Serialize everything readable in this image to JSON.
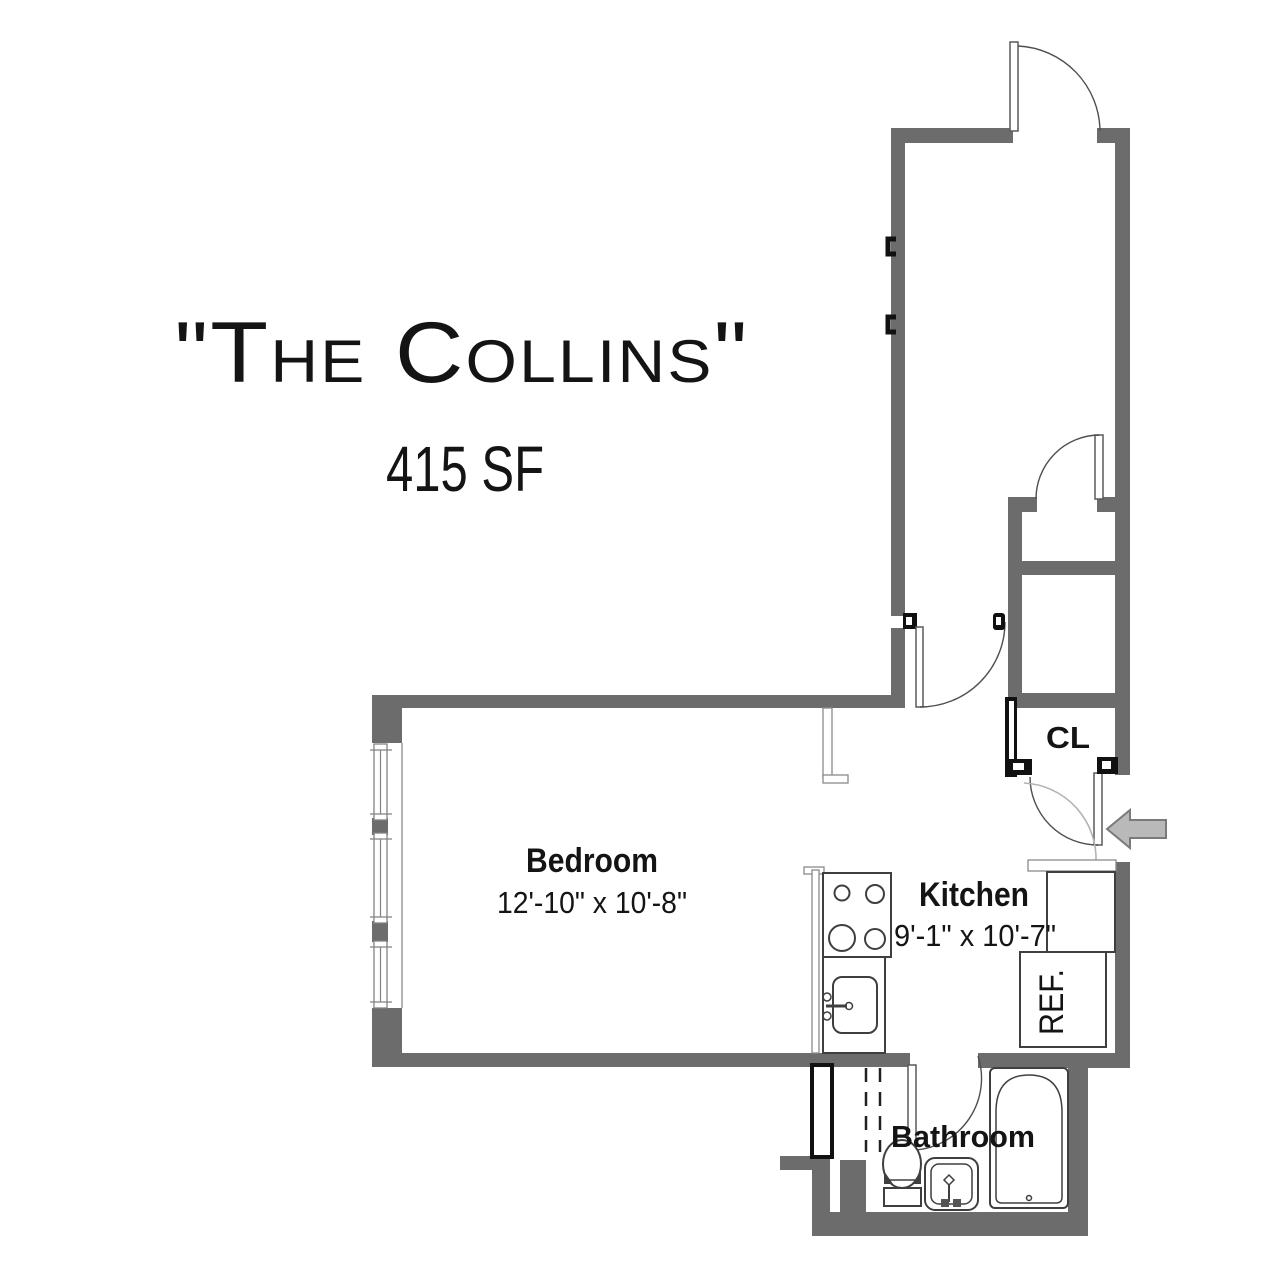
{
  "title": {
    "name": "\"The Collins\"",
    "area": "415 SF"
  },
  "rooms": {
    "bedroom": {
      "label": "Bedroom",
      "dims": "12'-10\" x 10'-8\""
    },
    "kitchen": {
      "label": "Kitchen",
      "dims": "9'-1\" x 10'-7\""
    },
    "bathroom": {
      "label": "Bathroom"
    },
    "closet": {
      "label": "CL"
    },
    "refrigerator": {
      "label": "REF."
    }
  },
  "colors": {
    "wall": "#6c6c6c",
    "line": "#3f3f3f",
    "black_symbol": "#111111",
    "arrow_fill": "#b9b9b9",
    "arrow_stroke": "#7a7a7a",
    "light_arc": "#b3b3b3",
    "text": "#141414"
  }
}
